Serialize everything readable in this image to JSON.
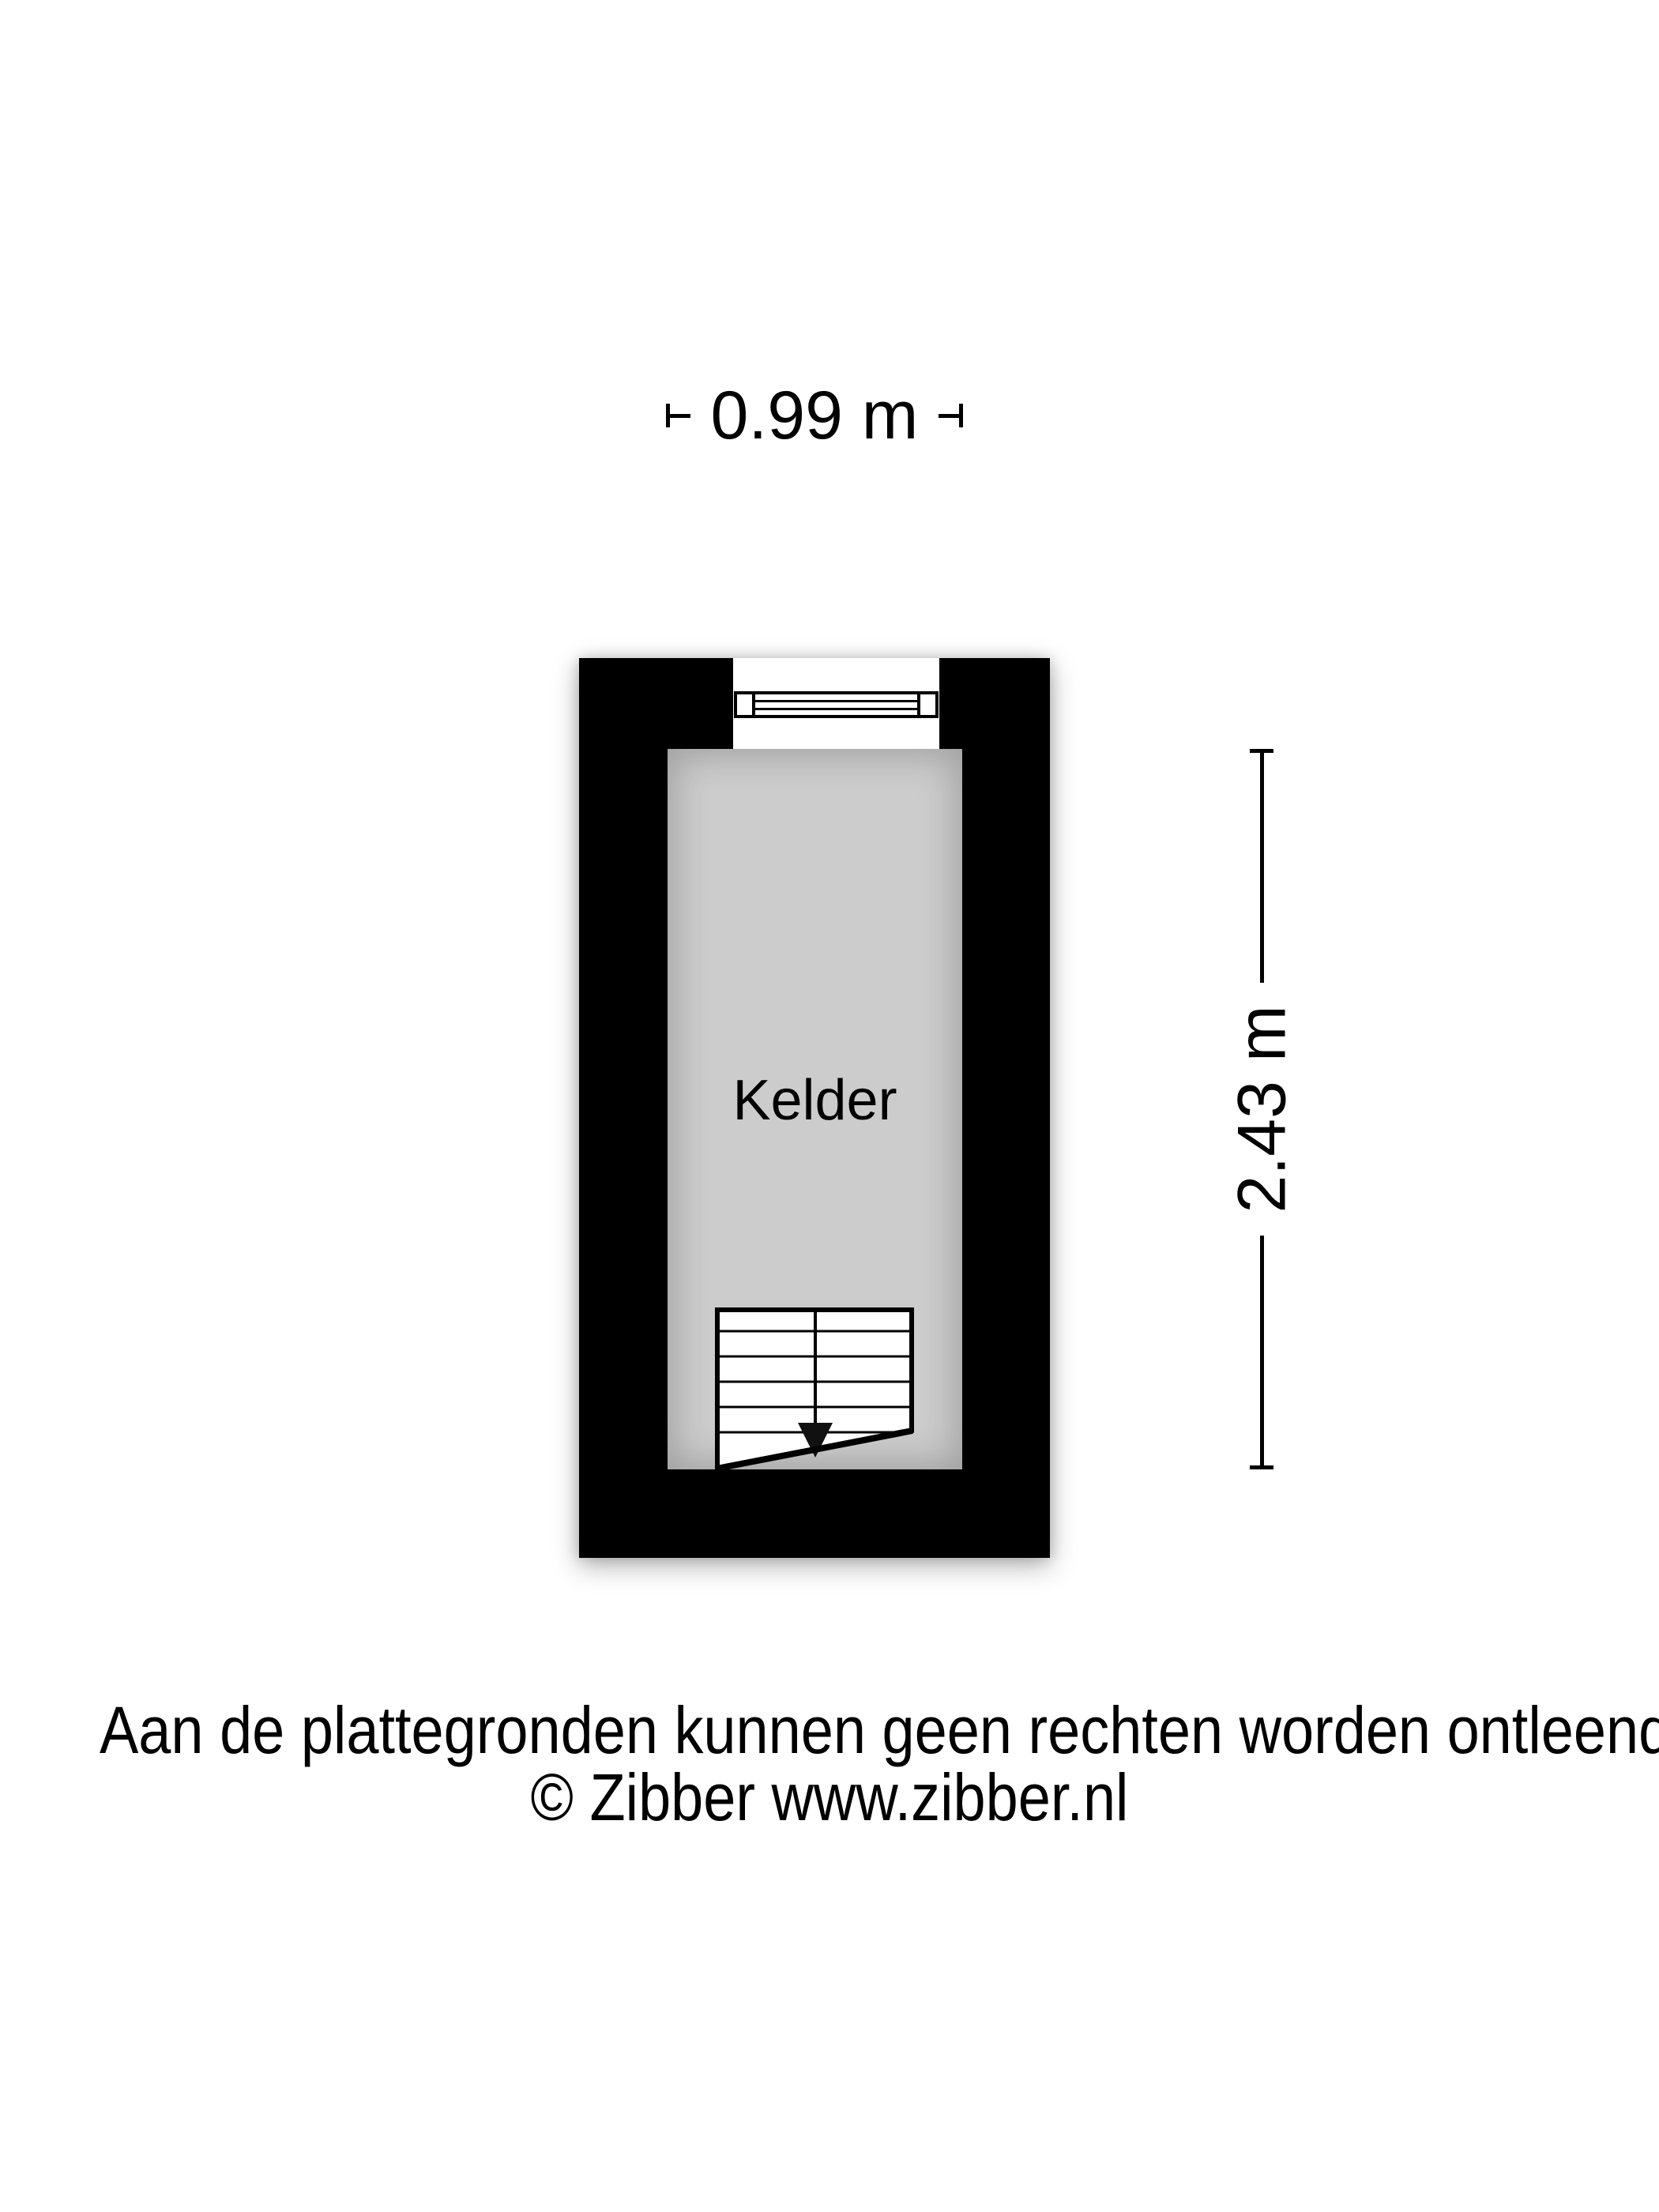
{
  "floorplan": {
    "room_label": "Kelder",
    "dim_width": {
      "label": "0.99 m"
    },
    "dim_height": {
      "label": "2.43 m"
    },
    "symbols": {
      "window": "window-symbol",
      "stairs": "stairs-down-symbol"
    },
    "colors": {
      "wall": "#000000",
      "floor": "#cccccc",
      "background": "#ffffff",
      "symbol_fill": "#ffffff",
      "line": "#000000"
    }
  },
  "footer": {
    "disclaimer": "Aan de plattegronden kunnen geen rechten worden ontleend",
    "copyright": "© Zibber www.zibber.nl"
  }
}
